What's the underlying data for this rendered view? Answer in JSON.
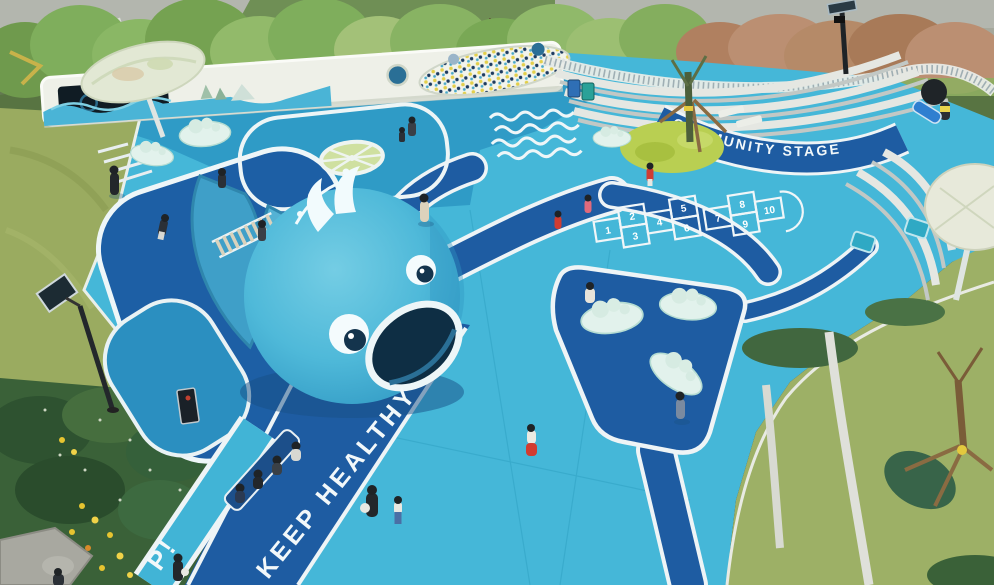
{
  "markings": {
    "community_stage": "COMMUNITY STAGE",
    "keep_healthy": "KEEP HEALTHY",
    "path_word_partial": "P!",
    "hopscotch_court_a": [
      "1",
      "2",
      "3",
      "4",
      "5",
      "6"
    ],
    "hopscotch_court_b": [
      "7",
      "8",
      "9",
      "10"
    ]
  },
  "colors": {
    "ground_light": "#45b7d8",
    "ground_mid": "#2f9bc6",
    "path_dark": "#1e5ca2",
    "line_white": "#eef4f6",
    "whale_body": "#4fb9d9",
    "grass": "#9aab60",
    "mural_wall": "#eef0e8",
    "canopy": "#e2e8d4",
    "seat_mint": "#def0ea",
    "accent_red": "#d03c32",
    "car_yellow": "#e8c428"
  }
}
